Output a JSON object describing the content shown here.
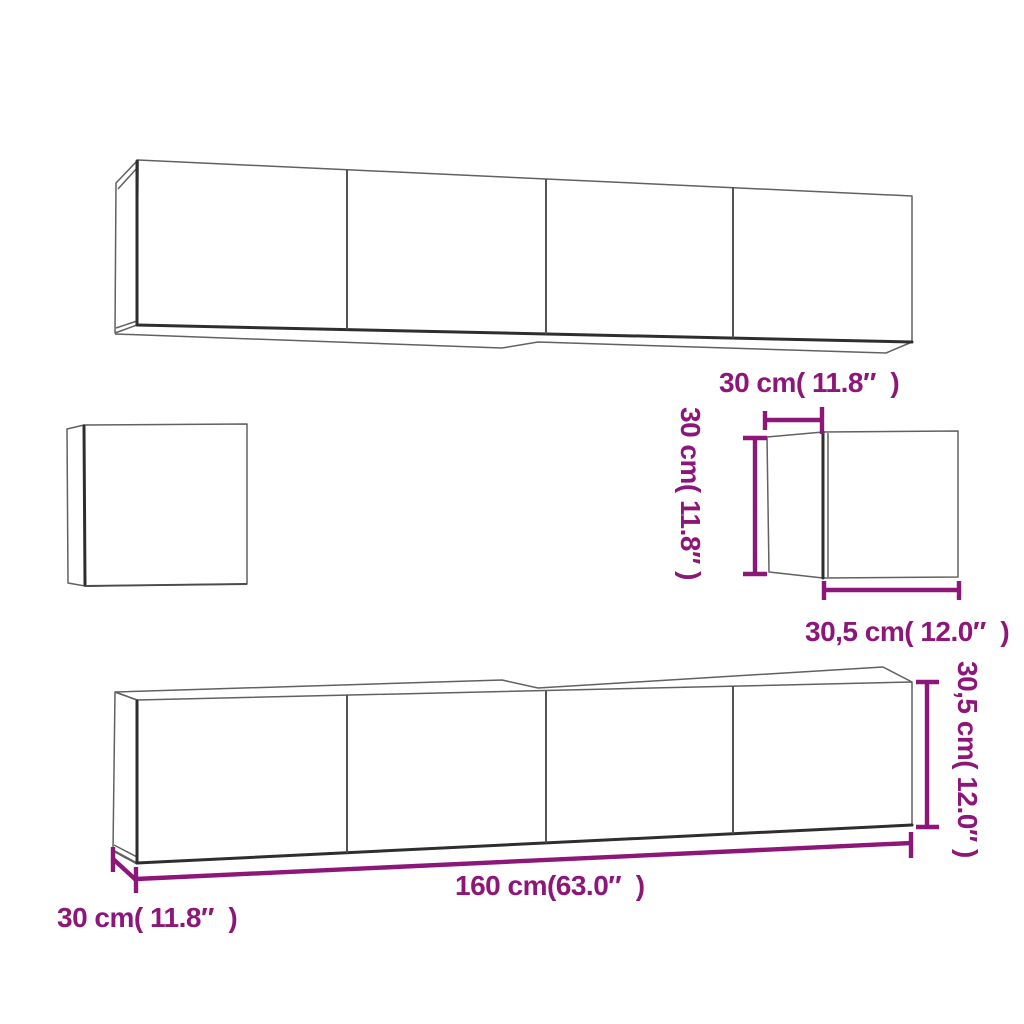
{
  "colors": {
    "background": "#ffffff",
    "drawing_line": "#616161",
    "dimension_accent": "#8d1679"
  },
  "labels": {
    "cube_depth_top": "30 cm( 11.8″  )",
    "cube_height_left": "30 cm( 11.8″ )",
    "cube_width_bottom": "30,5 cm( 12.0″  )",
    "long_cabinet_width": "160 cm(63.0″  )",
    "long_cabinet_depth": "30 cm( 11.8″  )",
    "long_cabinet_height": "30,5 cm( 12.0″ )"
  }
}
